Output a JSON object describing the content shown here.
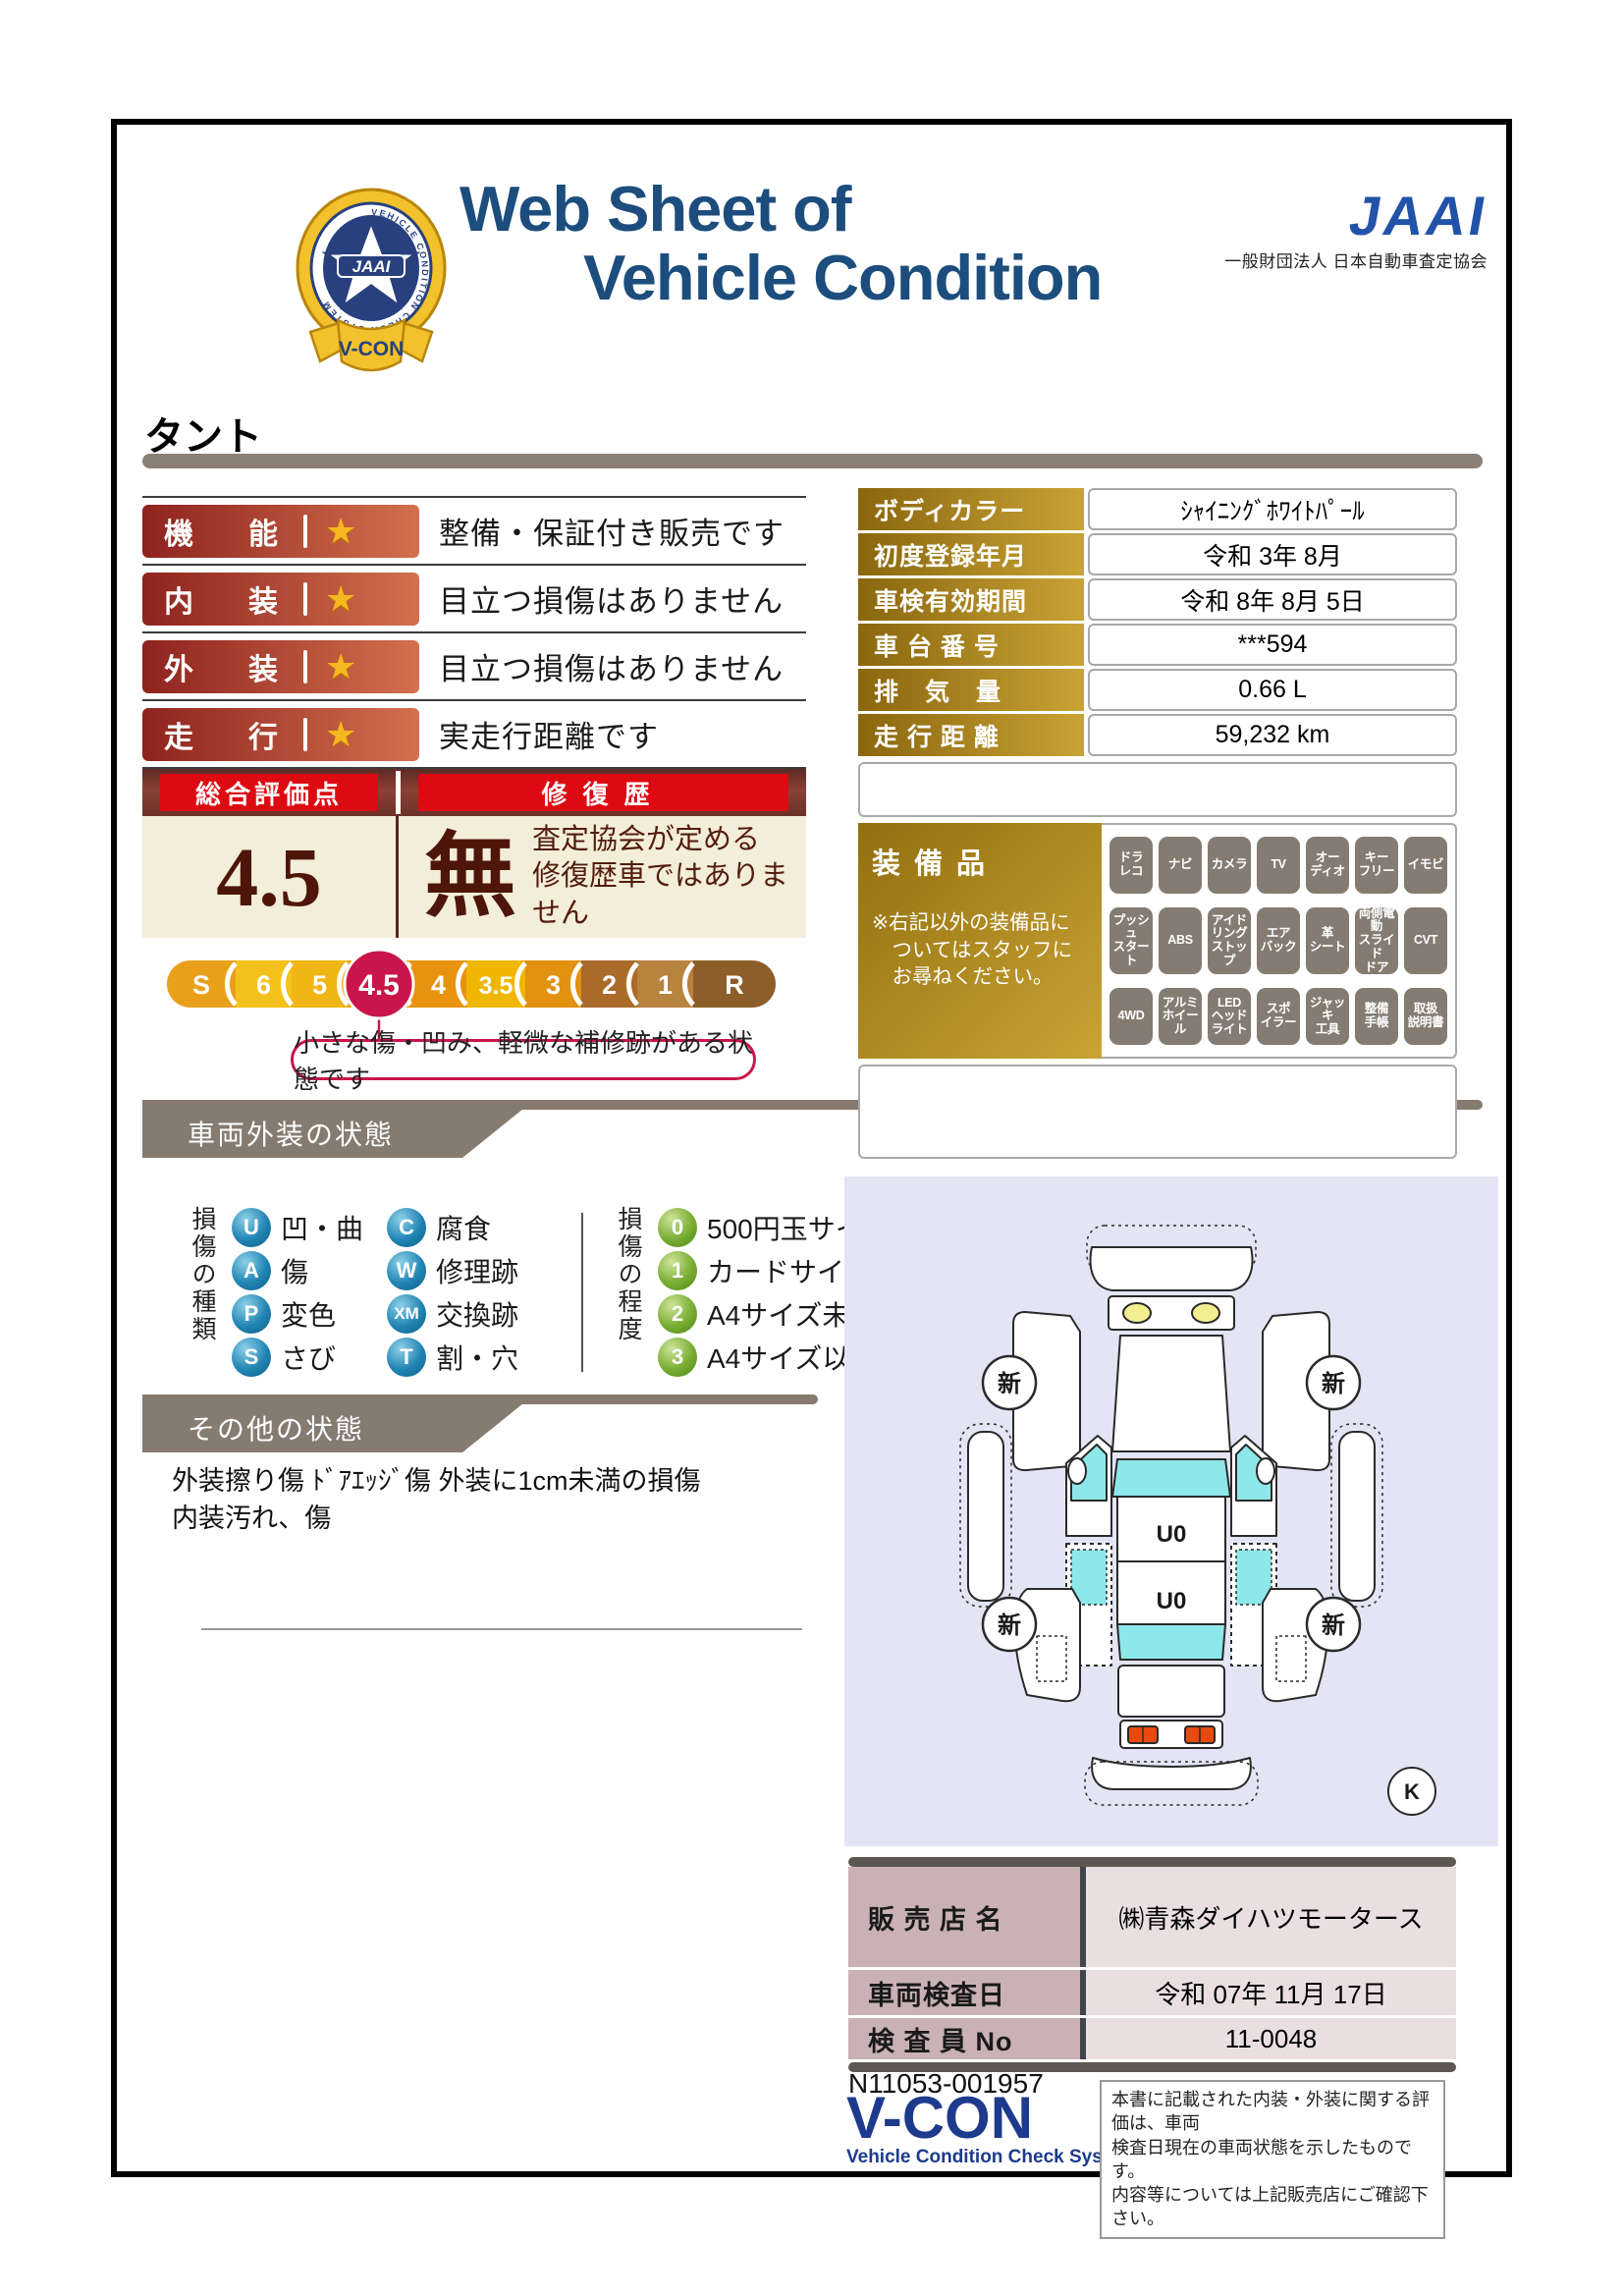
{
  "header": {
    "title_line1": "Web Sheet of",
    "title_line2": "Vehicle Condition",
    "jaai_word": "JAAI",
    "jaai_org": "一般財団法人 日本自動車査定協会",
    "badge": {
      "vcon": "V-CON",
      "jaai": "JAAI",
      "ring_text": "VEHICLE CONDITION CHECK SYSTEM"
    }
  },
  "vehicle_name": "タント",
  "ratings": [
    {
      "label": "機能",
      "caption": "整備・保証付き販売です"
    },
    {
      "label": "内装",
      "caption": "目立つ損傷はありません"
    },
    {
      "label": "外装",
      "caption": "目立つ損傷はありません"
    },
    {
      "label": "走行",
      "caption": "実走行距離です"
    }
  ],
  "overall": {
    "header_left": "総合評価点",
    "header_right": "修復歴",
    "score": "4.5",
    "repair_mark": "無",
    "repair_note_line1": "査定協会が定める",
    "repair_note_line2": "修復歴車ではありません",
    "callout": "小さな傷・凹み、軽微な補修跡がある状態です",
    "scale": {
      "highlight_color": "#c9164a",
      "segments": [
        {
          "label": "S",
          "color": "#e8a01b",
          "highlight": false
        },
        {
          "label": "6",
          "color": "#f4c11c",
          "highlight": false
        },
        {
          "label": "5",
          "color": "#eeb515",
          "highlight": false
        },
        {
          "label": "4.5",
          "color": "#eb9d12",
          "highlight": true
        },
        {
          "label": "4",
          "color": "#e8930f",
          "highlight": false
        },
        {
          "label": "3.5",
          "color": "#efb702",
          "highlight": false
        },
        {
          "label": "3",
          "color": "#e29110",
          "highlight": false
        },
        {
          "label": "2",
          "color": "#aa6a2a",
          "highlight": false
        },
        {
          "label": "1",
          "color": "#b8833f",
          "highlight": false
        },
        {
          "label": "R",
          "color": "#8d5e2a",
          "highlight": false
        }
      ]
    }
  },
  "details": {
    "rows": [
      {
        "label": "ボディカラー",
        "value": "ｼｬｲﾆﾝｸﾞﾎﾜｲﾄﾊﾟｰﾙ"
      },
      {
        "label": "初度登録年月",
        "value": "令和 3年 8月"
      },
      {
        "label": "車検有効期間",
        "value": "令和 8年 8月 5日"
      },
      {
        "label": "車 台 番 号",
        "value": "***594"
      },
      {
        "label": "排　気　量",
        "value": "0.66 L"
      },
      {
        "label": "走 行 距 離",
        "value": "59,232 km"
      }
    ]
  },
  "equipment": {
    "title": "装備品",
    "note_lines": [
      "※右記以外の装備品に",
      "　ついてはスタッフに",
      "　お尋ねください。"
    ],
    "items": [
      [
        "ドラ",
        "レコ"
      ],
      [
        "ナビ"
      ],
      [
        "カメラ"
      ],
      [
        "TV"
      ],
      [
        "オー",
        "ディオ"
      ],
      [
        "キー",
        "フリー"
      ],
      [
        "イモビ"
      ],
      [
        "プッシュ",
        "スタート"
      ],
      [
        "ABS"
      ],
      [
        "アイド",
        "リング",
        "ストップ"
      ],
      [
        "エア",
        "バック"
      ],
      [
        "革",
        "シート"
      ],
      [
        "両側電動",
        "スライド",
        "ドア"
      ],
      [
        "CVT"
      ],
      [
        "4WD"
      ],
      [
        "アルミ",
        "ホイール"
      ],
      [
        "LED",
        "ヘッド",
        "ライト"
      ],
      [
        "スポ",
        "イラー"
      ],
      [
        "ジャッキ",
        "工具"
      ],
      [
        "整備",
        "手帳"
      ],
      [
        "取扱",
        "説明書"
      ]
    ]
  },
  "exterior": {
    "banner": "車両外装の状態",
    "type_label": "損傷の種類",
    "types": [
      {
        "code": "U",
        "name": "凹・曲"
      },
      {
        "code": "A",
        "name": "傷"
      },
      {
        "code": "P",
        "name": "変色"
      },
      {
        "code": "S",
        "name": "さび"
      },
      {
        "code": "C",
        "name": "腐食"
      },
      {
        "code": "W",
        "name": "修理跡"
      },
      {
        "code": "XM",
        "name": "交換跡"
      },
      {
        "code": "T",
        "name": "割・穴"
      }
    ],
    "degree_label": "損傷の程度",
    "degrees": [
      {
        "code": "0",
        "name": "500円玉サイズ未満"
      },
      {
        "code": "1",
        "name": "カードサイズ未満"
      },
      {
        "code": "2",
        "name": "A4サイズ未満"
      },
      {
        "code": "3",
        "name": "A4サイズ以上"
      }
    ]
  },
  "other": {
    "banner": "その他の状態",
    "notes": [
      "外装擦り傷 ﾄﾞｱｴｯｼﾞ傷 外装に1cm未満の損傷",
      "内装汚れ、傷"
    ]
  },
  "diagram": {
    "wheel_label": "新",
    "roof_marks": [
      "U0",
      "U0"
    ],
    "corner_label": "K",
    "glass_color": "#8ee8ea",
    "panel_bg": "#e3e5f4"
  },
  "dealer": {
    "rows": [
      {
        "label": "販 売 店 名",
        "value": "㈱青森ダイハツモータース"
      },
      {
        "label": "車両検査日",
        "value": "令和 07年 11月 17日"
      },
      {
        "label": "検 査 員 No",
        "value": "11-0048"
      }
    ]
  },
  "footer": {
    "serial": "N11053-001957",
    "vcon": "V-CON",
    "vcon_sub": "Vehicle Condition Check System",
    "disclaimer_lines": [
      "本書に記載された内装・外装に関する評価は、車両",
      "検査日現在の車両状態を示したものです。",
      "内容等については上記販売店にご確認下さい。"
    ]
  },
  "colors": {
    "title_blue": "#1c4d7d",
    "jaai_blue": "#2353a8",
    "accent_red": "#de0a12",
    "badge_maroon_start": "#8e231e",
    "badge_maroon_end": "#d3704e",
    "gold_start": "#8a660e",
    "gold_end": "#c9a335",
    "banner_gray": "#857b71",
    "highlight_crimson": "#c9164a",
    "cream": "#f3eed9",
    "equipment_gray": "#847c72"
  }
}
